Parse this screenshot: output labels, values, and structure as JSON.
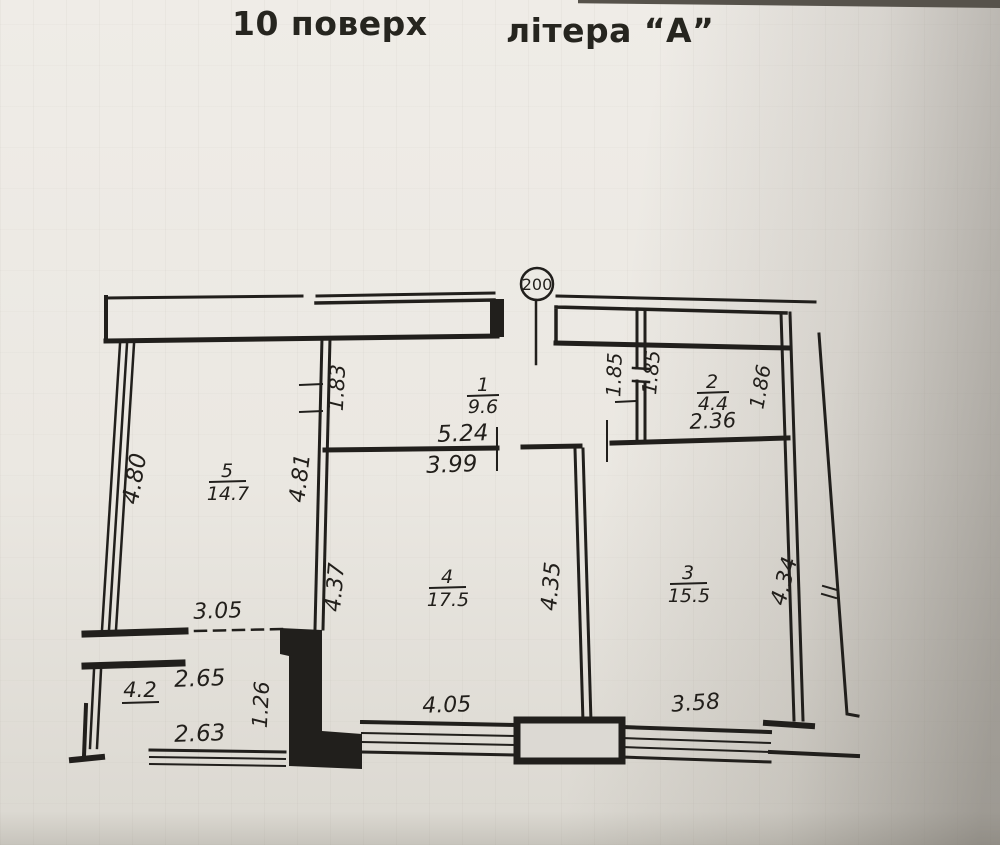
{
  "title": {
    "floor_label": "10 поверх",
    "block_label": "літера “А”"
  },
  "plan": {
    "axis_marker": "200",
    "rooms": [
      {
        "number": "1",
        "area": "9.6"
      },
      {
        "number": "2",
        "area": "4.4"
      },
      {
        "number": "3",
        "area": "15.5"
      },
      {
        "number": "4",
        "area": "17.5"
      },
      {
        "number": "5",
        "area": "14.7"
      },
      {
        "number": "",
        "area": "4.2"
      }
    ],
    "dimensions": {
      "room5_door": "1.83",
      "hall_width_top": "5.24",
      "hall_width_bottom": "3.99",
      "room2_door_left": "1.85",
      "room2_door_right": "1.85",
      "room2_width": "2.36",
      "room2_depth": "1.86",
      "room5_left_height": "4.80",
      "room5_right_height": "4.81",
      "room4_left_height": "4.37",
      "room4_right_height": "4.35",
      "room3_right_height": "4.34",
      "balcony_opening": "3.05",
      "balcony_width_top": "2.65",
      "pillar_height": "1.26",
      "balcony_width_bottom": "2.63",
      "room4_window": "4.05",
      "room3_window": "3.58"
    }
  },
  "colors": {
    "paper": "#ebe8e2",
    "ink": "#211f1c",
    "shadow": "#6b665e"
  }
}
